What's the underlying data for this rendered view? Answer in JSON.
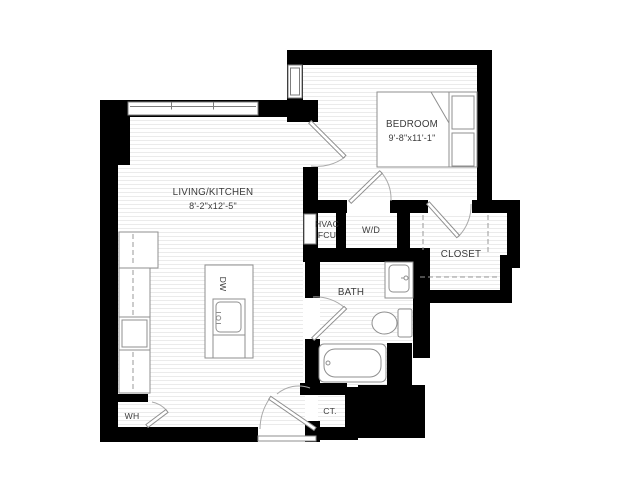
{
  "rooms": {
    "living": {
      "name": "LIVING/KITCHEN",
      "dims": "8'-2\"x12'-5\""
    },
    "bedroom": {
      "name": "BEDROOM",
      "dims": "9'-8\"x11'-1\""
    },
    "hvac": {
      "line1": "HVAC",
      "line2": "FCU"
    },
    "laundry": {
      "name": "W/D"
    },
    "closet": {
      "name": "CLOSET"
    },
    "bath": {
      "name": "BATH"
    },
    "water_heater": {
      "name": "WH"
    },
    "coat_closet": {
      "name": "CT."
    },
    "dishwasher": {
      "name": "DW"
    }
  },
  "colors": {
    "wall": "#000000",
    "background": "#ffffff",
    "fixture": "#8f8f8f",
    "door_arc": "#a9a9a9",
    "floor_line": "#ebebeb",
    "label": "#3c3c3c",
    "window_frame": "#7e7e7e",
    "dash": "#999999"
  }
}
